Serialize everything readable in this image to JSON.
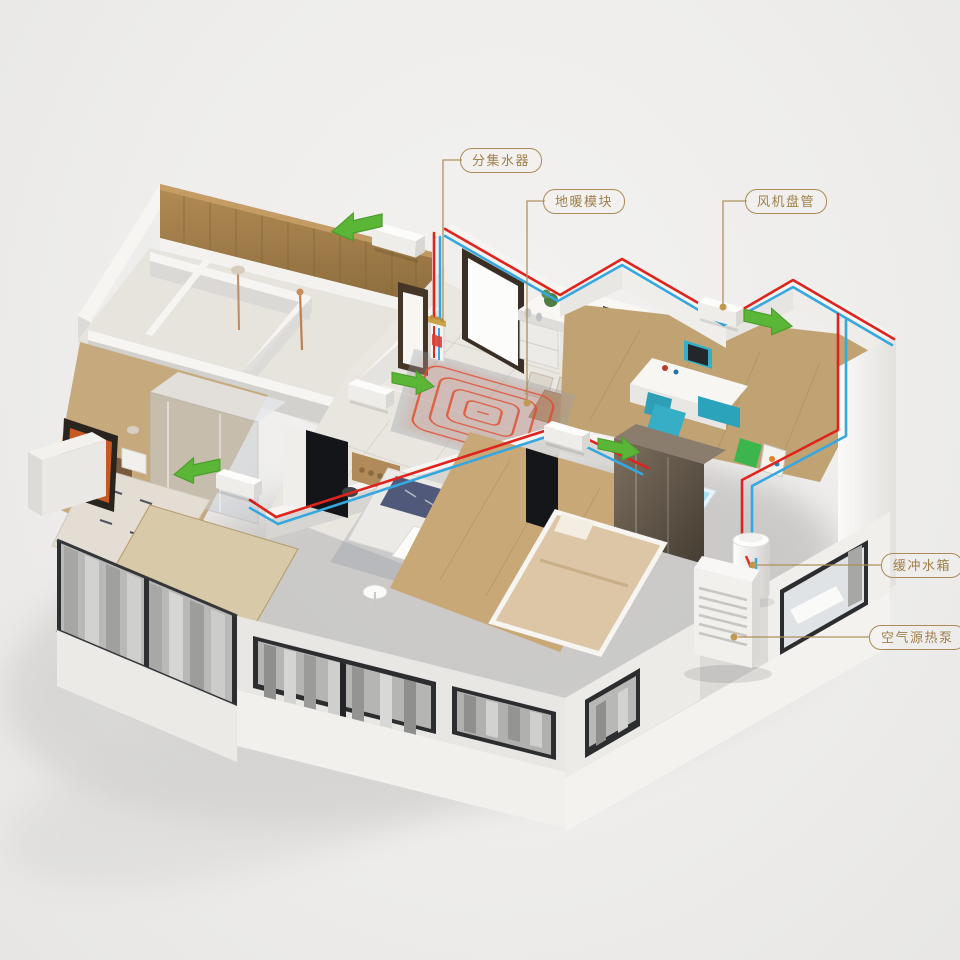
{
  "callouts": [
    {
      "id": "manifold",
      "text": "分集水器"
    },
    {
      "id": "floor-heating-module",
      "text": "地暖模块"
    },
    {
      "id": "fan-coil-unit",
      "text": "风机盘管"
    },
    {
      "id": "buffer-tank",
      "text": "缓冲水箱"
    },
    {
      "id": "air-source-heat-pump",
      "text": "空气源热泵"
    }
  ],
  "colors": {
    "callout_gold": "#ab8c58",
    "callout_text": "#9f7f49",
    "pipe_hot_red": "#e0231c",
    "pipe_cold_blue": "#36a7df",
    "airflow_green": "#5bb637"
  }
}
